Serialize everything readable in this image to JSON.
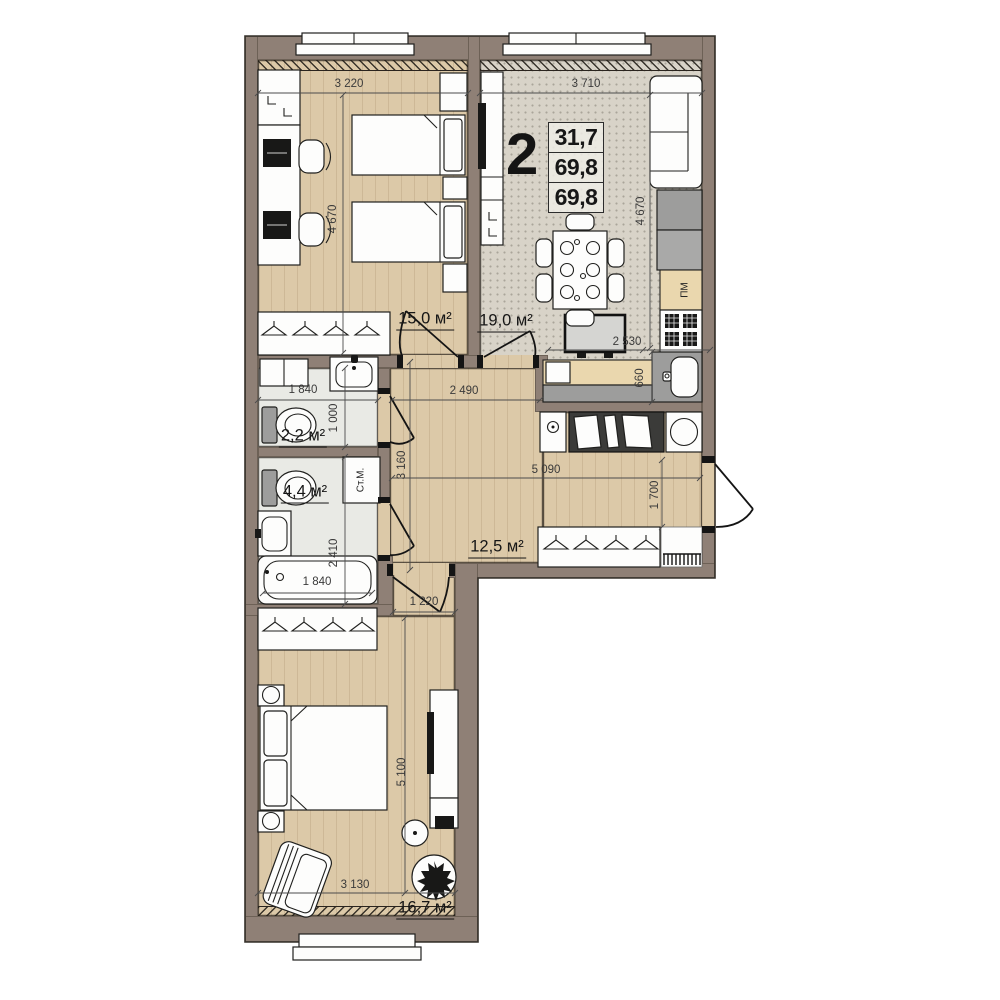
{
  "plan": {
    "apartment": {
      "rooms_count": "2",
      "area_rows": [
        "31,7",
        "69,8",
        "69,8"
      ]
    },
    "rooms": {
      "bedroom1": {
        "area": "15,0 м²"
      },
      "kitchen_living": {
        "area": "19,0 м²"
      },
      "wc": {
        "area": "2,2 м²"
      },
      "bathroom": {
        "area": "4,4 м²"
      },
      "hallway": {
        "area": "12,5 м²"
      },
      "bedroom2": {
        "area": "16,7 м²"
      }
    },
    "dimensions_mm": {
      "bedroom1_width": "3 220",
      "kitchen_living_width": "3 710",
      "bedroom1_height": "4 670",
      "kitchen_living_height": "4 670",
      "kitchen_counter_width": "2 530",
      "kitchen_counter_depth": "660",
      "hallway_top_width": "2 490",
      "hallway_height": "3 160",
      "hallway_width": "5 090",
      "entry_wall": "1 700",
      "wc_width": "1 840",
      "wc_depth": "1 000",
      "bathroom_depth": "2 410",
      "bathtub_length": "1 840",
      "corridor_width": "1 220",
      "bedroom2_height": "5 100",
      "bedroom2_width": "3 130"
    },
    "appliances": {
      "washing_machine": "Ст.М.",
      "dishwasher": "ПМ"
    },
    "colors": {
      "wall": "#8f8076",
      "wood_floor": "#dcc9a8",
      "carpet_floor": "#d8d3c8",
      "tile_floor": "#e9eae5",
      "cabinet_grey": "#9d9d9c",
      "counter_wood": "#ead7ae",
      "outline": "#20201e"
    }
  }
}
